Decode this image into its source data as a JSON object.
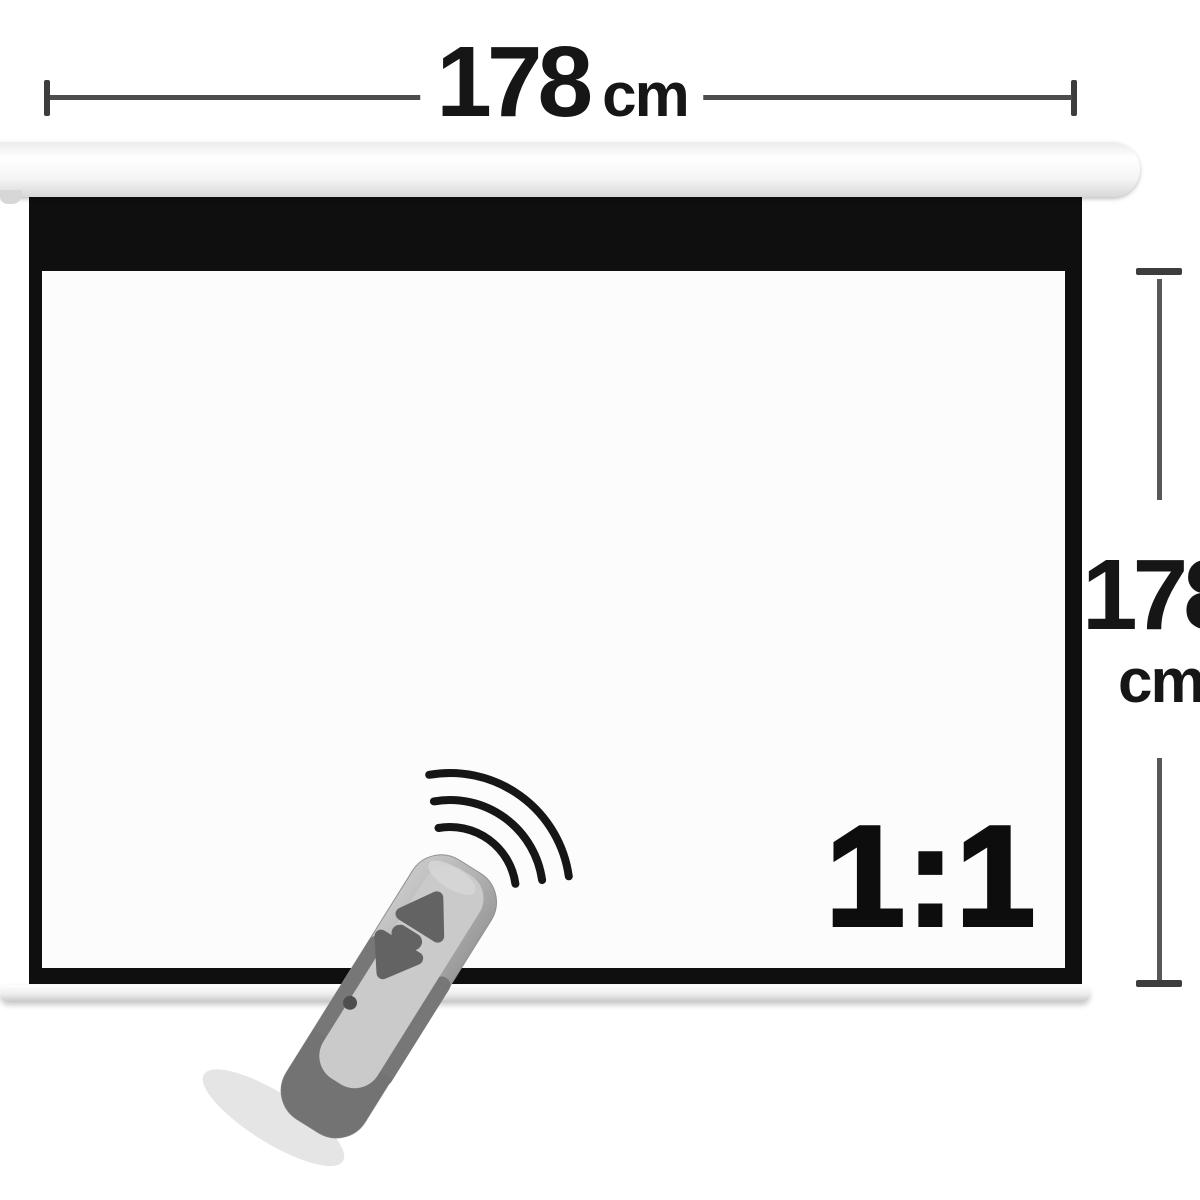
{
  "dimensions": {
    "width": {
      "value": "178",
      "unit": "cm"
    },
    "height": {
      "value": "178",
      "unit": "cm"
    }
  },
  "screen": {
    "aspect_ratio_label": "1:1"
  },
  "icons": {
    "remote": "remote-control-icon",
    "waves": "signal-waves-icon"
  },
  "colors": {
    "background": "#ffffff",
    "screen_frame": "#0f0f0f",
    "screen_surface": "#fcfcfc",
    "dimension_line": "#4d4d4d",
    "text": "#161616",
    "housing": "#f2f2f2",
    "remote_body": "#b5b5b5",
    "remote_dark": "#747474",
    "remote_buttons": "#646464"
  }
}
